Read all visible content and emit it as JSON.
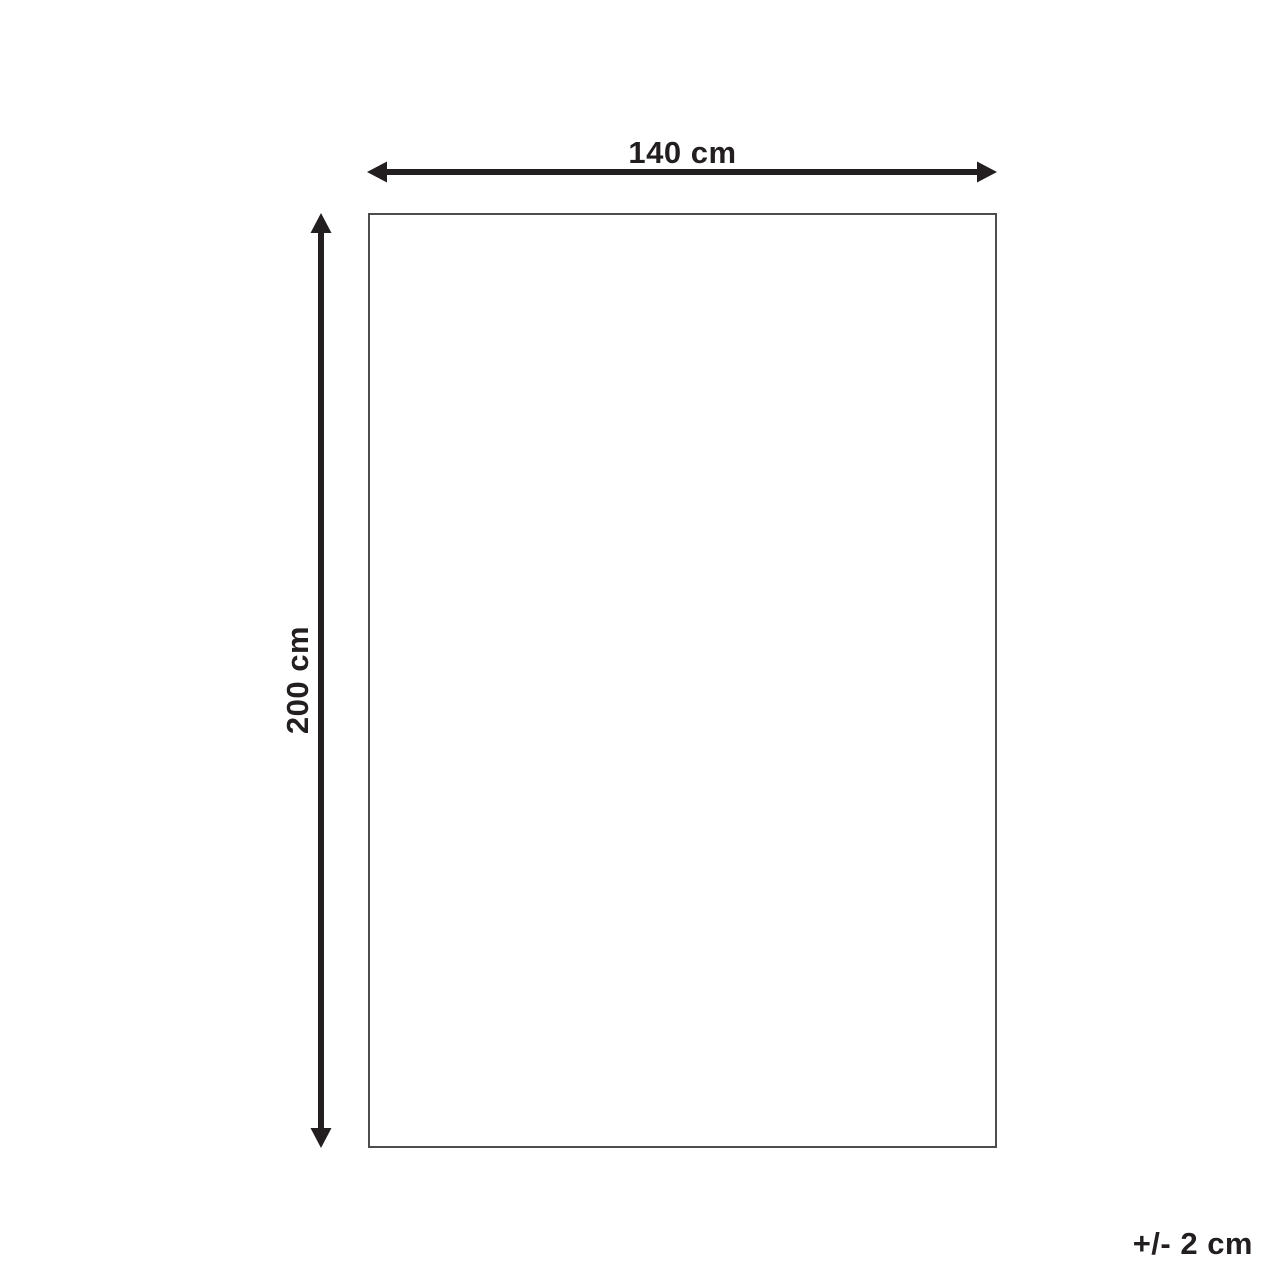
{
  "diagram": {
    "title": "product-dimension-diagram",
    "width_label": "140 cm",
    "height_label": "200 cm",
    "tolerance_label": "+/- 2 cm",
    "shape": "rectangle"
  },
  "colors": {
    "arrow": "#231f20",
    "rect-border": "#4d4d4d",
    "text": "#231f20",
    "background": "#ffffff"
  }
}
